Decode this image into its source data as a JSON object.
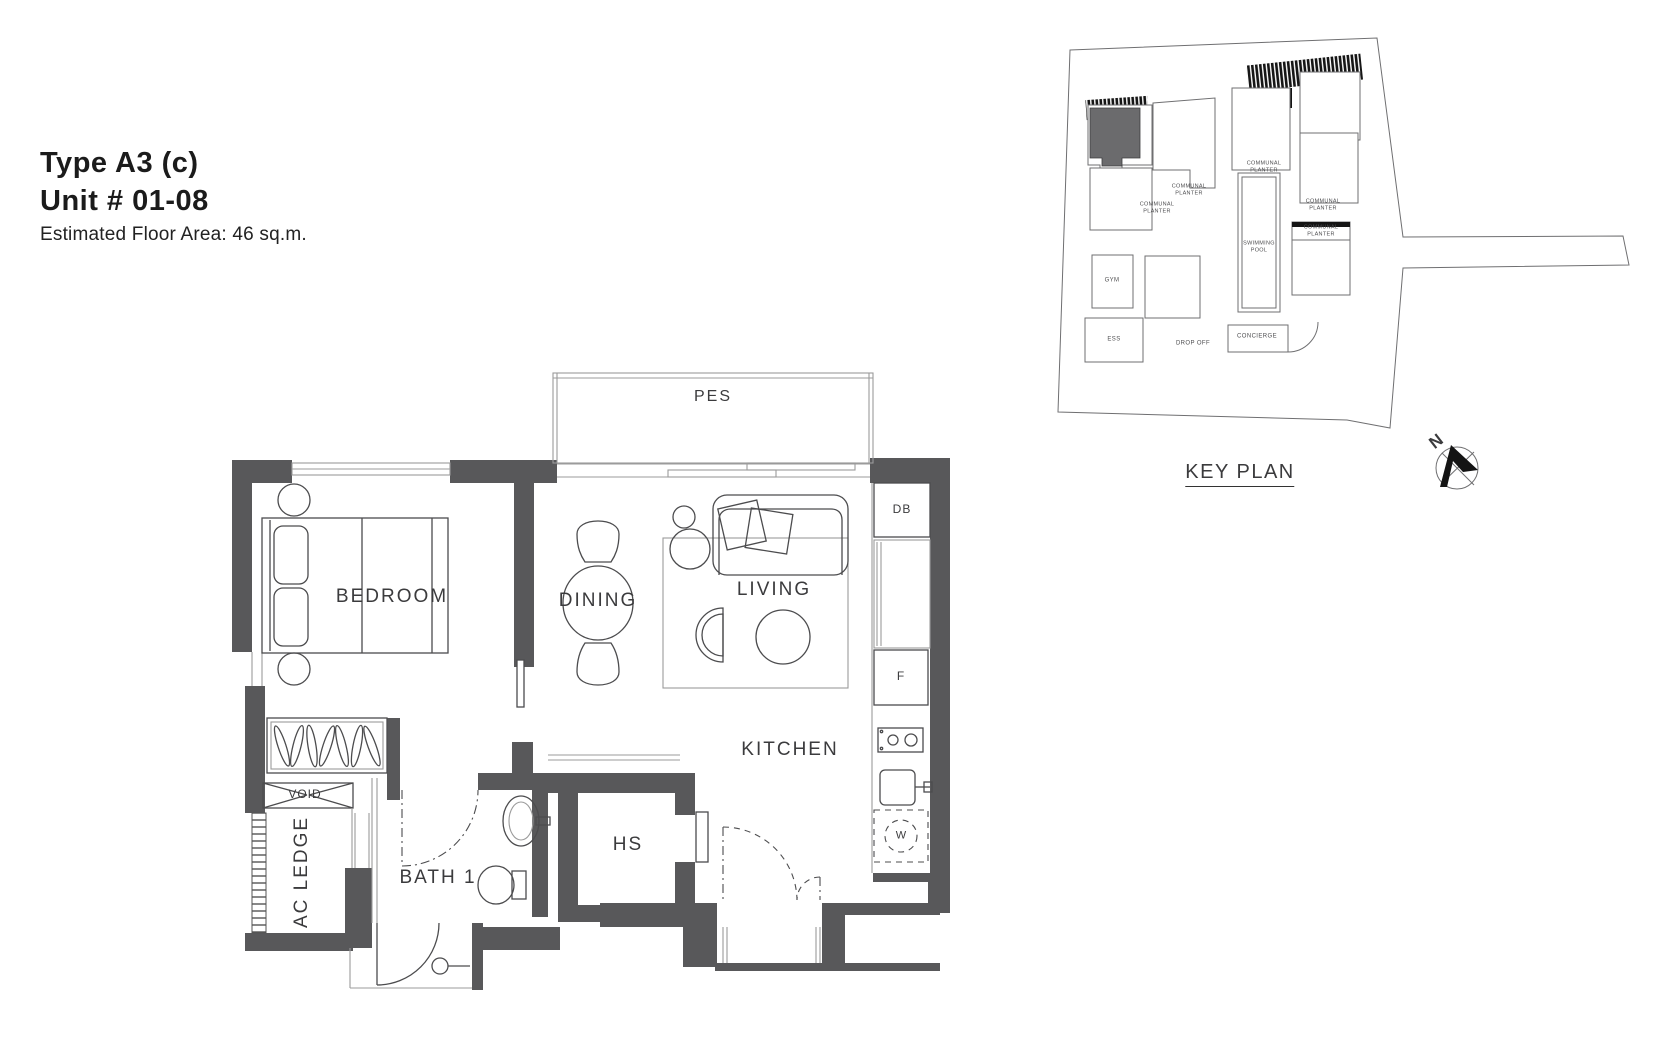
{
  "title_block": {
    "type_label": "Type A3 (c)",
    "unit_label": "Unit # 01-08",
    "area_label": "Estimated Floor Area: 46 sq.m."
  },
  "floor_plan": {
    "labels": {
      "pes": "PES",
      "bedroom": "BEDROOM",
      "dining": "DINING",
      "living": "LIVING",
      "kitchen": "KITCHEN",
      "bath": "BATH 1",
      "hs": "HS",
      "ac_ledge": "AC LEDGE",
      "void": "VOID",
      "db": "DB",
      "fridge": "F",
      "washer": "W"
    }
  },
  "key_plan": {
    "title": "KEY PLAN",
    "north": "N",
    "labels": {
      "communal_planter": "COMMUNAL\nPLANTER",
      "swimming_pool": "SWIMMING\nPOOL",
      "gym": "GYM",
      "ess": "ESS",
      "drop_off": "DROP OFF",
      "concierge": "CONCIERGE"
    }
  },
  "colors": {
    "wall": "#58585a",
    "line": "#4c4c4e",
    "light_line": "#9b9b9b",
    "text": "#3b3b3d",
    "highlight_unit": "#6b6b6d"
  }
}
